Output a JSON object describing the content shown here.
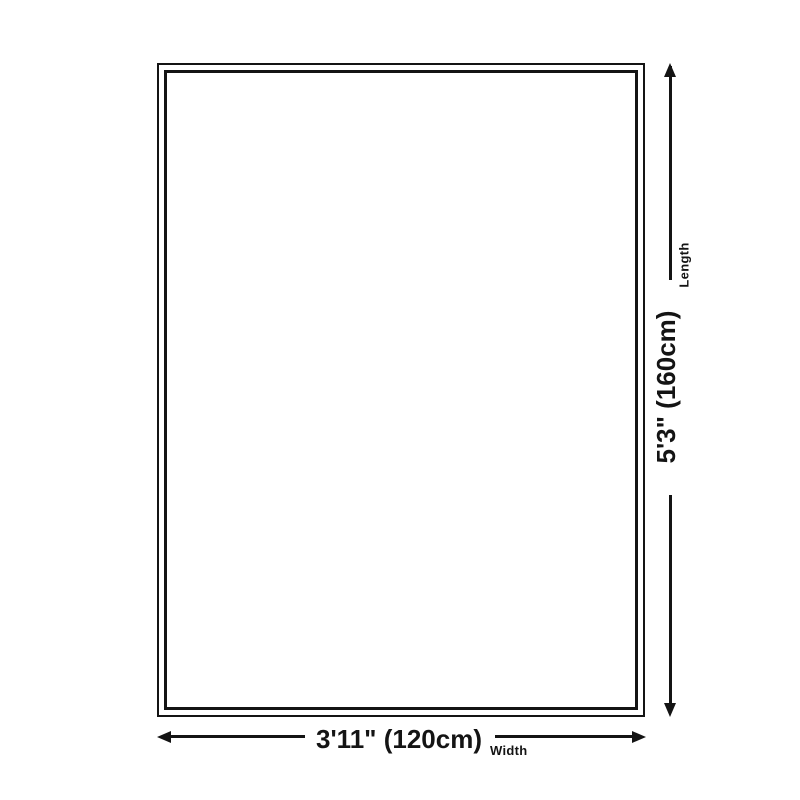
{
  "diagram": {
    "type": "product-dimension-diagram",
    "length_dimension": {
      "label": "Length",
      "value": "5'3\" (160cm)"
    },
    "width_dimension": {
      "label": "Width",
      "value": "3'11\" (120cm)"
    },
    "colors": {
      "line": "#141414",
      "background": "#ffffff"
    }
  }
}
